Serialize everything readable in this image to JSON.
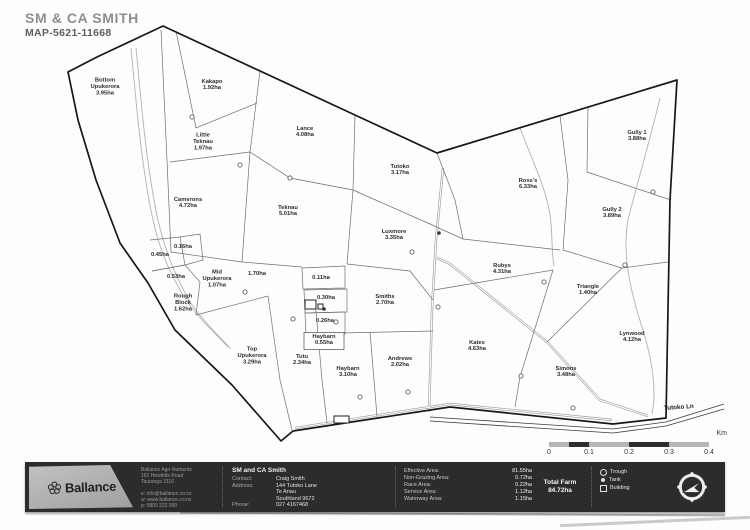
{
  "title": "SM & CA SMITH",
  "map_id": "MAP-5621-11668",
  "map": {
    "road_label": "Tutoko Ln",
    "paddocks": [
      {
        "lines": [
          "Bottom",
          "Upukerora",
          "3.95ha"
        ],
        "x": 105,
        "y": 88
      },
      {
        "lines": [
          "Kakapo",
          "1.92ha"
        ],
        "x": 212,
        "y": 86
      },
      {
        "lines": [
          "Little",
          "Teknau",
          "1.97ha"
        ],
        "x": 203,
        "y": 143
      },
      {
        "lines": [
          "Lance",
          "4.08ha"
        ],
        "x": 305,
        "y": 133
      },
      {
        "lines": [
          "Tutoko",
          "3.17ha"
        ],
        "x": 400,
        "y": 171
      },
      {
        "lines": [
          "Teknau",
          "5.01ha"
        ],
        "x": 288,
        "y": 212
      },
      {
        "lines": [
          "Camerons",
          "4.72ha"
        ],
        "x": 188,
        "y": 204
      },
      {
        "lines": [
          "Ross's",
          "6.33ha"
        ],
        "x": 528,
        "y": 185
      },
      {
        "lines": [
          "Gully 1",
          "3.88ha"
        ],
        "x": 637,
        "y": 137
      },
      {
        "lines": [
          "Gully 2",
          "3.89ha"
        ],
        "x": 612,
        "y": 214
      },
      {
        "lines": [
          "Luxmore",
          "3.35ha"
        ],
        "x": 394,
        "y": 236
      },
      {
        "lines": [
          "Rubys",
          "4.31ha"
        ],
        "x": 502,
        "y": 270
      },
      {
        "lines": [
          "0.45ha"
        ],
        "x": 160,
        "y": 256
      },
      {
        "lines": [
          "0.16ha"
        ],
        "x": 183,
        "y": 248
      },
      {
        "lines": [
          "0.53ha"
        ],
        "x": 176,
        "y": 278
      },
      {
        "lines": [
          "Mid",
          "Upukerora",
          "1.07ha"
        ],
        "x": 217,
        "y": 280
      },
      {
        "lines": [
          "1.70ha"
        ],
        "x": 257,
        "y": 275
      },
      {
        "lines": [
          "0.11ha"
        ],
        "x": 321,
        "y": 279
      },
      {
        "lines": [
          "0.30ha"
        ],
        "x": 326,
        "y": 299
      },
      {
        "lines": [
          "0.26ha"
        ],
        "x": 325,
        "y": 322
      },
      {
        "lines": [
          "Haybarn",
          "0.55ha"
        ],
        "x": 324,
        "y": 341,
        "boxed": true
      },
      {
        "lines": [
          "Rough",
          "Block",
          "1.62ha"
        ],
        "x": 183,
        "y": 304
      },
      {
        "lines": [
          "Smiths",
          "2.70ha"
        ],
        "x": 385,
        "y": 301
      },
      {
        "lines": [
          "Triangle",
          "1.40ha"
        ],
        "x": 588,
        "y": 291
      },
      {
        "lines": [
          "Lynwood",
          "4.12ha"
        ],
        "x": 632,
        "y": 338
      },
      {
        "lines": [
          "Top",
          "Upukerora",
          "3.29ha"
        ],
        "x": 252,
        "y": 357
      },
      {
        "lines": [
          "Tutu",
          "2.34ha"
        ],
        "x": 302,
        "y": 361
      },
      {
        "lines": [
          "Haybarn",
          "3.10ha"
        ],
        "x": 348,
        "y": 373
      },
      {
        "lines": [
          "Andrews",
          "2.02ha"
        ],
        "x": 400,
        "y": 363
      },
      {
        "lines": [
          "Kates",
          "4.63ha"
        ],
        "x": 477,
        "y": 347
      },
      {
        "lines": [
          "Simons",
          "3.48ha"
        ],
        "x": 566,
        "y": 373
      }
    ],
    "symbols": {
      "troughs": [
        [
          192,
          117
        ],
        [
          240,
          165
        ],
        [
          290,
          178
        ],
        [
          412,
          252
        ],
        [
          653,
          192
        ],
        [
          625,
          265
        ],
        [
          544,
          282
        ],
        [
          521,
          376
        ],
        [
          573,
          408
        ],
        [
          245,
          292
        ],
        [
          293,
          319
        ],
        [
          360,
          397
        ],
        [
          408,
          392
        ],
        [
          336,
          322
        ],
        [
          438,
          307
        ]
      ],
      "tanks": [
        [
          439,
          233
        ],
        [
          324,
          309
        ]
      ],
      "buildings": [
        [
          305,
          300,
          11,
          9
        ],
        [
          318,
          304,
          5,
          5
        ],
        [
          334,
          416,
          15,
          7
        ]
      ]
    }
  },
  "scale_bar": {
    "unit": "Km",
    "ticks": [
      "0",
      "0.1",
      "0.2",
      "0.3",
      "0.4"
    ]
  },
  "footer": {
    "brand": "Ballance",
    "company_lines": [
      "Ballance Agri-Nutrients",
      "161 Hewletts Road",
      "Tauranga 3116",
      "",
      "e: info@ballance.co.nz",
      "w: www.ballance.co.nz",
      "p: 0800 222 090"
    ],
    "customer": {
      "name": "SM and CA Smith",
      "rows": [
        [
          "Contact:",
          "Craig Smith"
        ],
        [
          "Address:",
          "144 Tutoko Lane"
        ],
        [
          "",
          "Te Anau"
        ],
        [
          "",
          "Southland 9672"
        ],
        [
          "Phone:",
          "027 4167468"
        ]
      ]
    },
    "areas": [
      [
        "Effective Area:",
        "81.55ha"
      ],
      [
        "Non-Grazing Area:",
        "0.72ha"
      ],
      [
        "Race Area:",
        "0.22ha"
      ],
      [
        "Service Area:",
        "1.12ha"
      ],
      [
        "Waterway Area:",
        "1.15ha"
      ]
    ],
    "total": {
      "label": "Total Farm",
      "value": "84.72ha"
    },
    "legend": [
      {
        "icon": "trough",
        "label": "Trough"
      },
      {
        "icon": "tank",
        "label": "Tank"
      },
      {
        "icon": "building",
        "label": "Building"
      }
    ]
  }
}
